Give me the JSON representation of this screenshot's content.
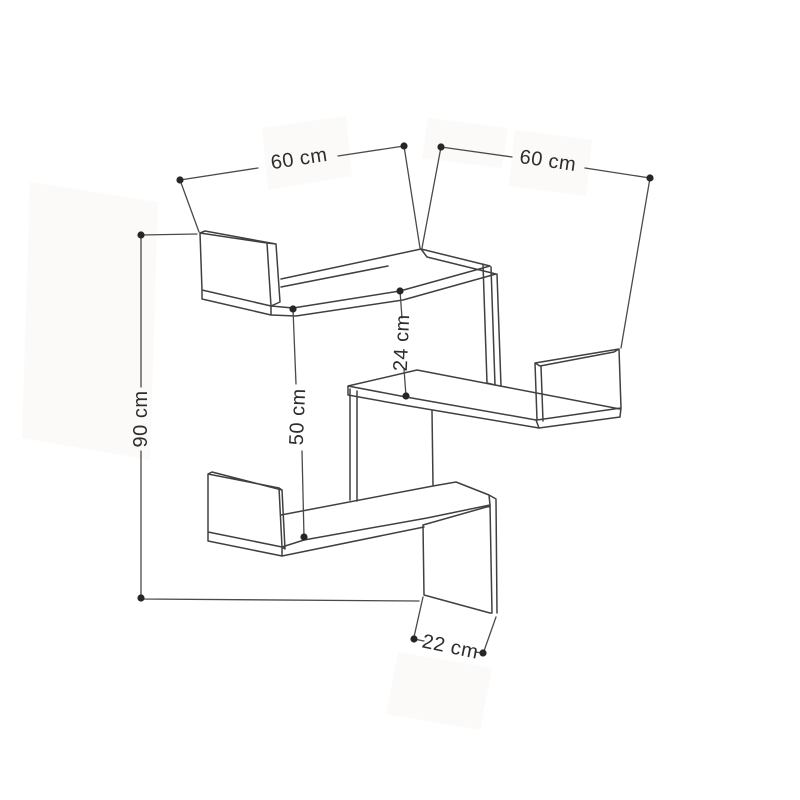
{
  "diagram": {
    "subject": "corner-wall-shelf-dimension-drawing",
    "colors": {
      "background": "#ffffff",
      "line": "#404040",
      "dimension_line": "#4a4a4a",
      "dot": "#262626",
      "text": "#2d2d2d"
    },
    "dimensions": {
      "top_shelf_width": {
        "label": "60 cm"
      },
      "right_shelf_width": {
        "label": "60 cm"
      },
      "total_height": {
        "label": "90 cm"
      },
      "large_gap_height": {
        "label": "50 cm"
      },
      "small_gap_height": {
        "label": "24 cm"
      },
      "shelf_depth": {
        "label": "22 cm"
      }
    }
  }
}
